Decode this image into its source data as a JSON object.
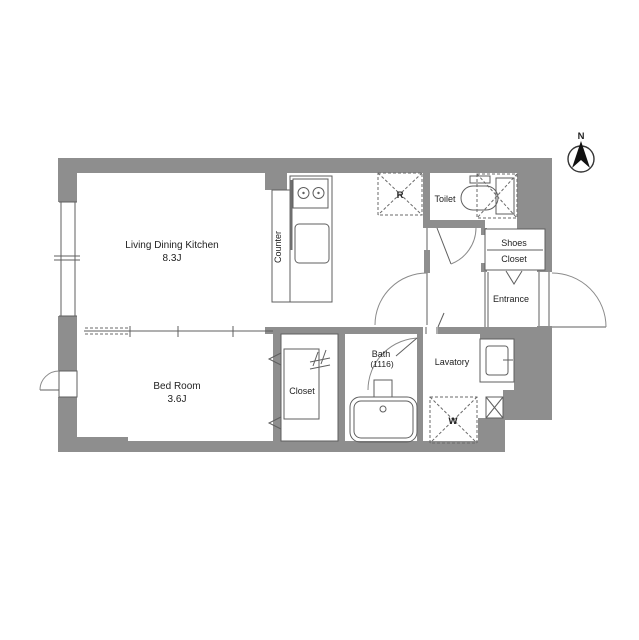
{
  "plan": {
    "title": "apartment-floor-plan",
    "rooms": {
      "ldk": {
        "name": "Living Dining Kitchen",
        "size": "8.3J"
      },
      "bedroom": {
        "name": "Bed Room",
        "size": "3.6J"
      },
      "closet": {
        "name": "Closet"
      },
      "bath": {
        "name": "Bath",
        "size": "(1116)"
      },
      "lavatory": {
        "name": "Lavatory"
      },
      "toilet": {
        "name": "Toilet"
      },
      "shoes_closet": {
        "line1": "Shoes",
        "line2": "Closet"
      },
      "entrance": {
        "name": "Entrance"
      },
      "counter": {
        "name": "Counter"
      }
    },
    "markers": {
      "refrigerator": "R",
      "washer": "W",
      "north": "N"
    },
    "colors": {
      "wall": "#8e8e8e",
      "line": "#5f5f5f",
      "text": "#222222"
    }
  }
}
